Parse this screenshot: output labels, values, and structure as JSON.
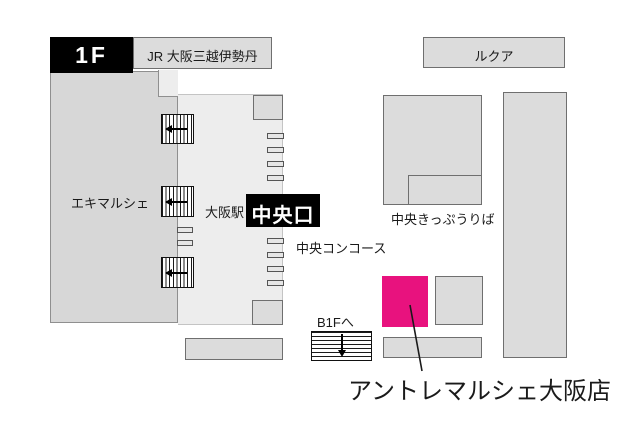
{
  "labels": {
    "floor": "1F",
    "jr_building": "JR 大阪三越伊勢丹",
    "lucua": "ルクア",
    "ekimarche": "エキマルシェ",
    "station": "大阪駅",
    "central_exit": "中央口",
    "central_concourse": "中央コンコース",
    "central_ticket_office": "中央きっぷうりば",
    "b1f": "B1Fへ",
    "store": "アントレマルシェ大阪店"
  },
  "colors": {
    "store_highlight": "#e8127e",
    "building_fill": "#dcdcdc",
    "ekimarche_fill": "#d7d7d7",
    "corridor_fill": "#ededed",
    "label_box_bg": "#000000"
  },
  "icons": {
    "stairs_west": "striped stairs with left arrow",
    "stairs_b1f": "striped stairs with down arrow",
    "store_pointer": "diagonal callout line"
  }
}
